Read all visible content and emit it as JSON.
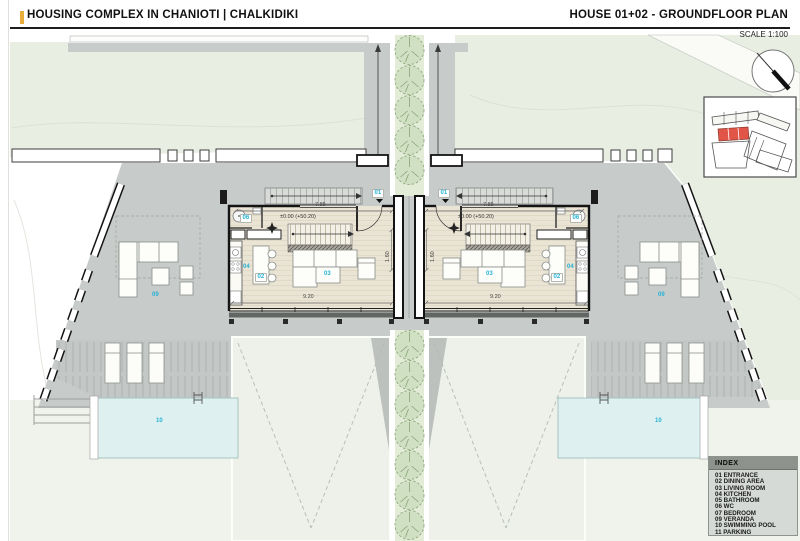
{
  "header": {
    "project_title": "HOUSING COMPLEX IN CHANIOTI | CHALKIDIKI",
    "sheet_title": "HOUSE 01+02 - GROUNDFLOOR PLAN",
    "scale_label": "SCALE 1:100",
    "accent_color": "#E8AE3C"
  },
  "plan": {
    "room_labels": {
      "entrance": "01",
      "dining_area": "02",
      "living_room": "03",
      "kitchen": "04",
      "wc": "06",
      "veranda": "09",
      "swimming_pool": "10"
    },
    "elevation_marker": "±0.00 (+50.20)",
    "dimensions": {
      "top_width": "7.85",
      "bottom_width": "9.20",
      "passage_width": "1.60"
    },
    "colors": {
      "label_cyan": "#25B2D6",
      "terrace_gray": "#C7CBCA",
      "grass_green": "#E9EEE3",
      "tree_green": "#CFE0C3",
      "floor_beige": "#EAE4D4",
      "pool_blue": "#DEF1F0",
      "parking_pale": "#EDF1E9",
      "keyplan_highlight": "#E15548"
    }
  },
  "index": {
    "title": "INDEX",
    "items": [
      "01 ENTRANCE",
      "02 DINING AREA",
      "03 LIVING ROOM",
      "04 KITCHEN",
      "05 BATHROOM",
      "06 WC",
      "07 BEDROOM",
      "09 VERANDA",
      "10 SWIMMING POOL",
      "11 PARKING"
    ]
  }
}
